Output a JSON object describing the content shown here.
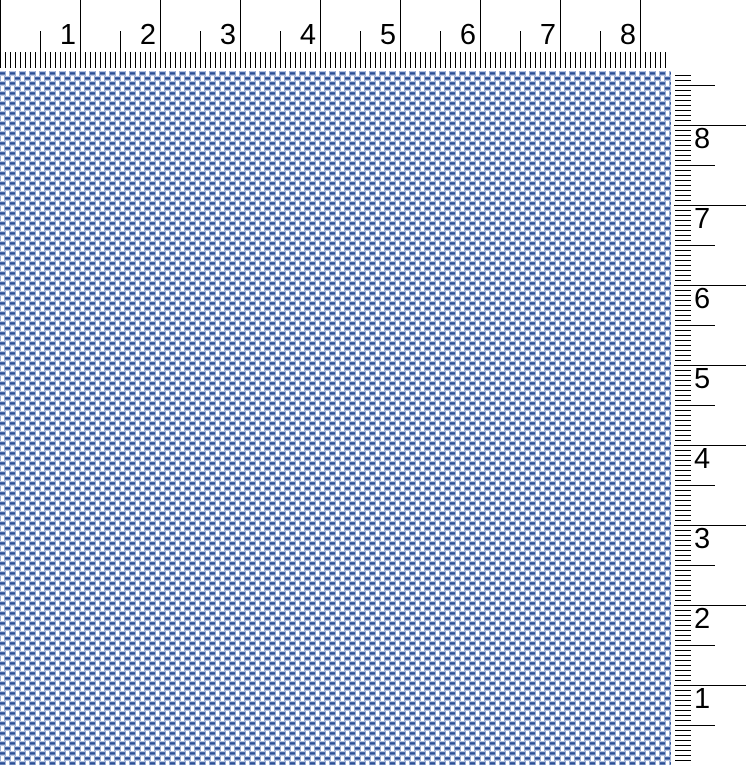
{
  "rulers": {
    "horizontal": {
      "position": "top",
      "unit": "inch",
      "labels": [
        "1",
        "2",
        "3",
        "4",
        "5",
        "6",
        "7",
        "8"
      ],
      "px_per_unit": 80,
      "minor_ticks_per_unit": 16,
      "minor_px": 5,
      "extent_px": 665
    },
    "vertical": {
      "position": "right",
      "unit": "inch",
      "origin": "bottom",
      "labels": [
        "8",
        "7",
        "6",
        "5",
        "4",
        "3",
        "2",
        "1"
      ],
      "px_per_unit": 80,
      "minor_ticks_per_unit": 16,
      "minor_px": 5
    }
  },
  "fabric": {
    "type": "weave-drawdown-preview",
    "threads_per_inch": 16,
    "cell_px": 5,
    "colors": {
      "weft_core": "#2b4f96",
      "weft_base": "#b9c7e3",
      "warp_face": "#ffffff",
      "warp_edge": "#92a8d0"
    }
  },
  "colors": {
    "background": "#ffffff",
    "tick": "#000000",
    "label": "#000000"
  }
}
